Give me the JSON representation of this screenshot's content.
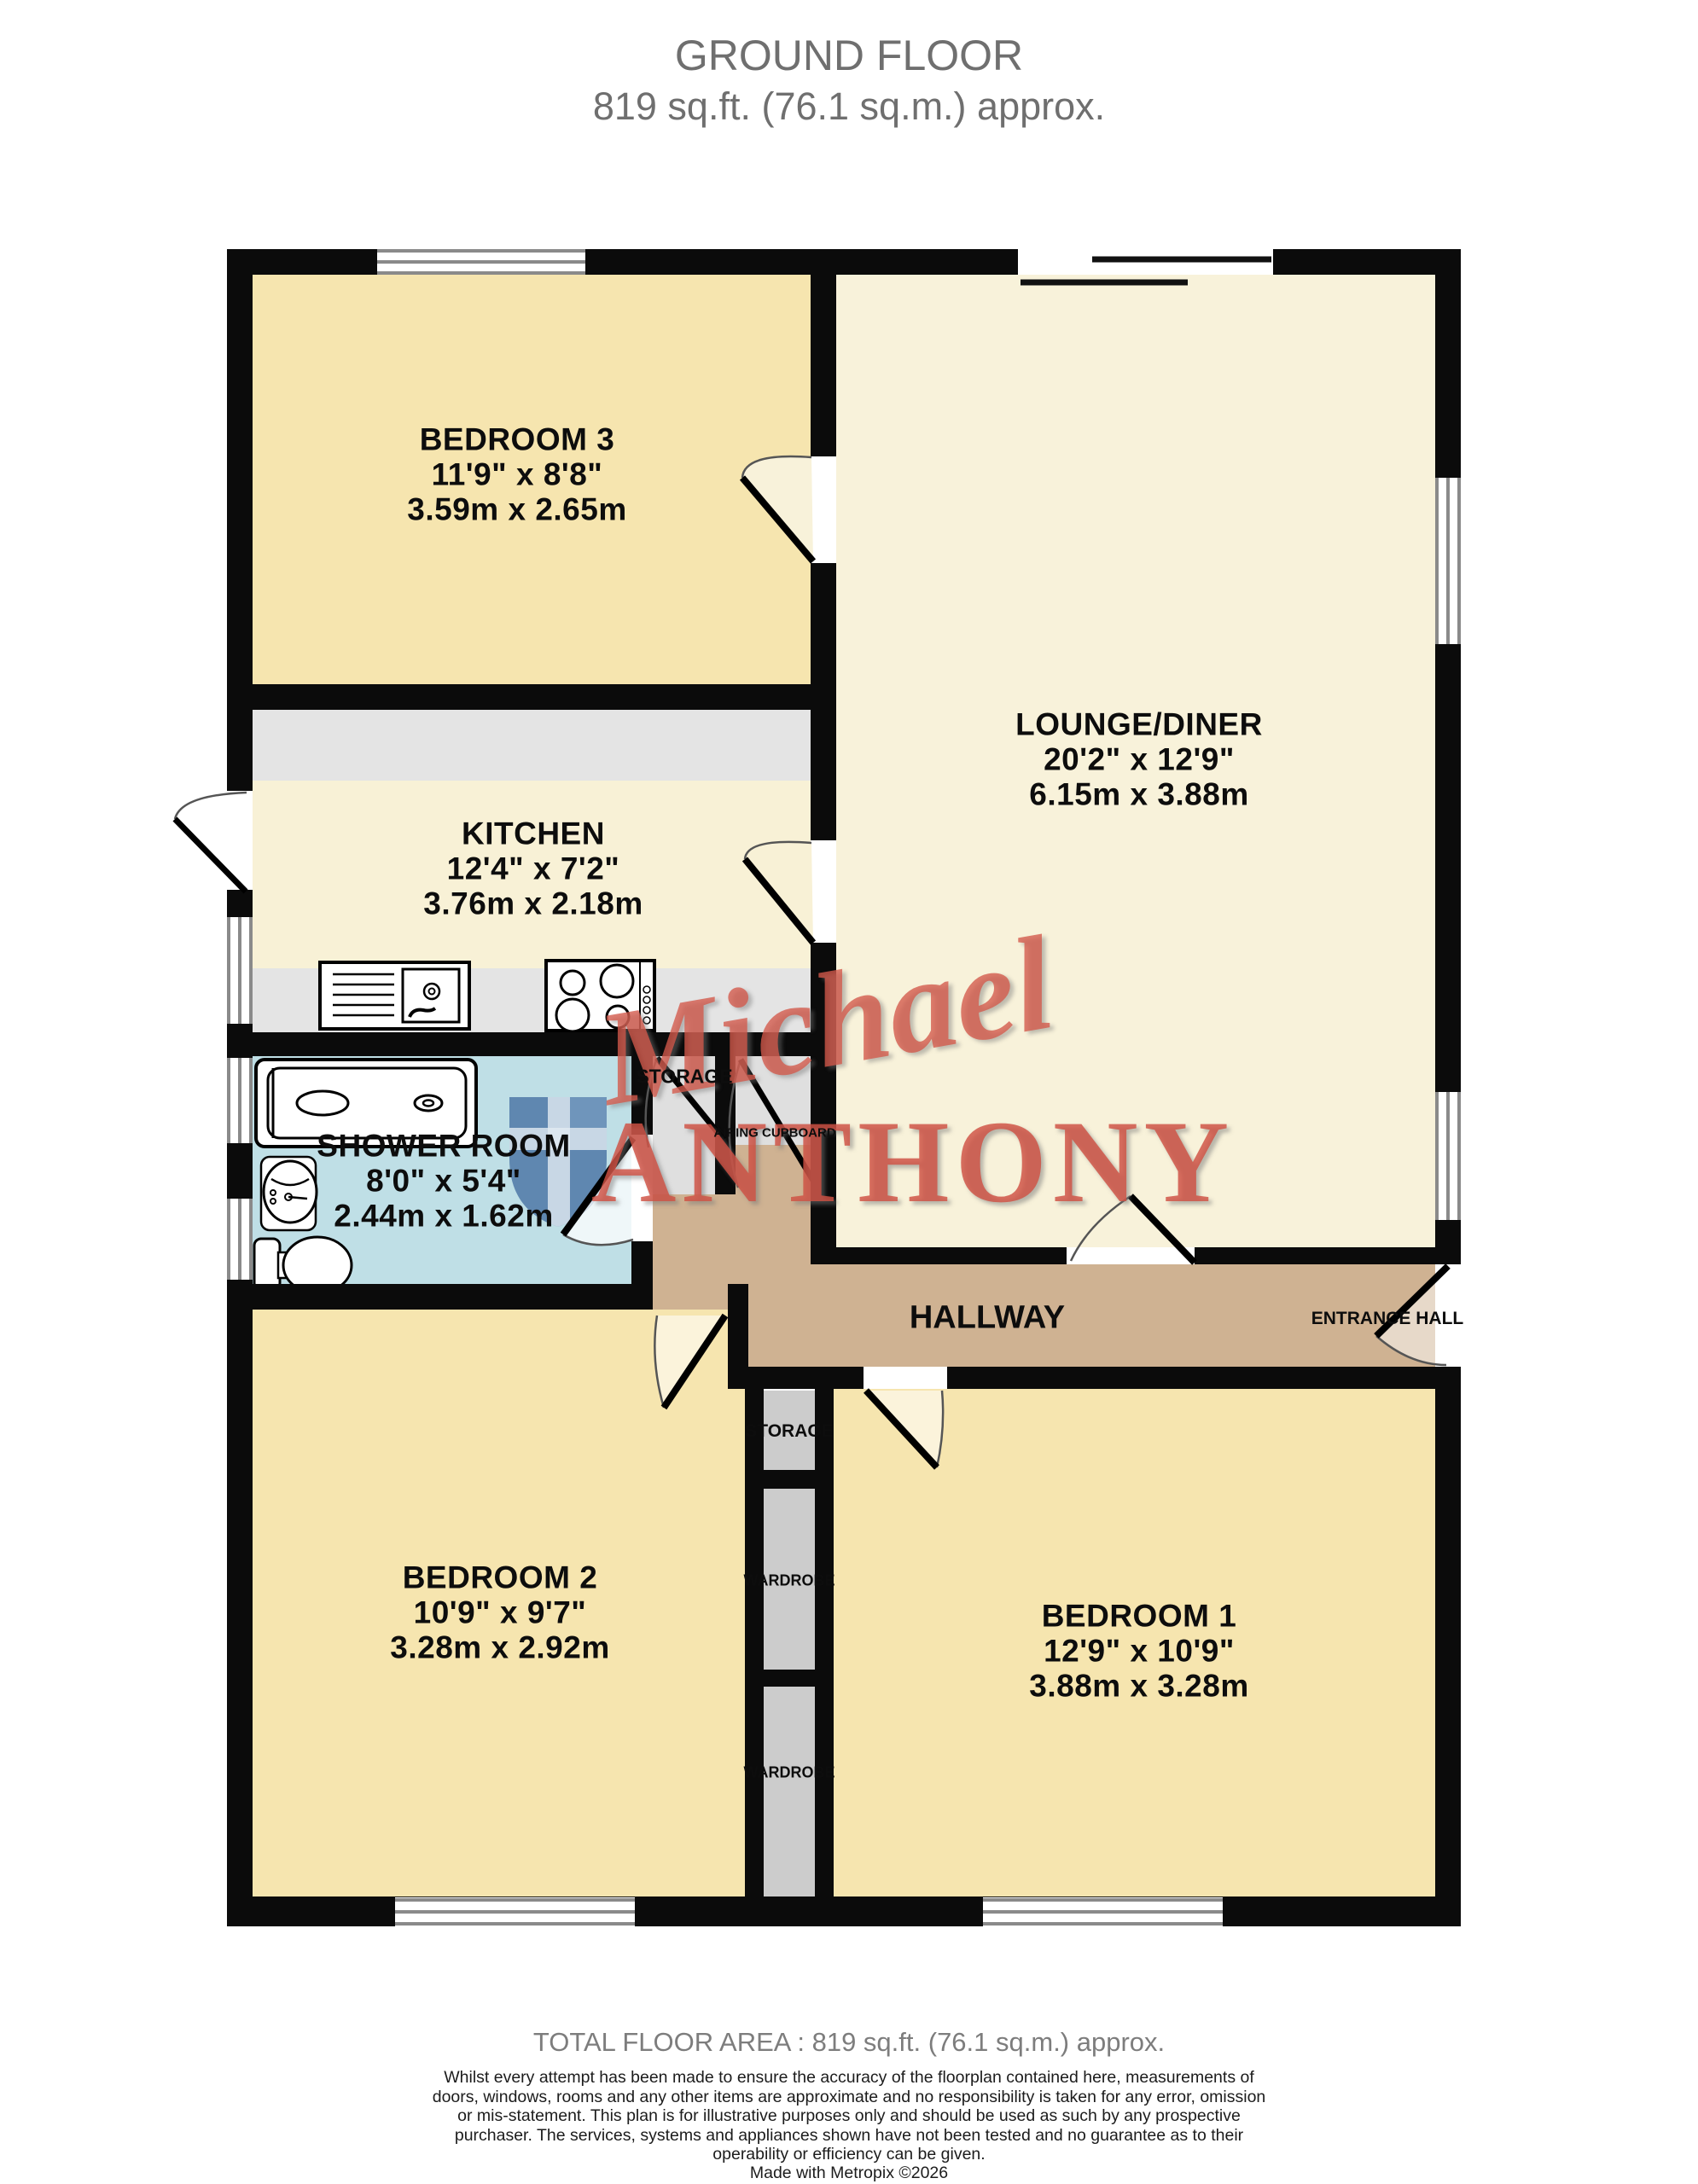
{
  "header": {
    "title": "GROUND FLOOR",
    "subtitle": "819 sq.ft. (76.1 sq.m.) approx."
  },
  "rooms": {
    "bedroom3": {
      "name": "BEDROOM 3",
      "imperial": "11'9\" x 8'8\"",
      "metric": "3.59m x 2.65m"
    },
    "lounge": {
      "name": "LOUNGE/DINER",
      "imperial": "20'2\" x 12'9\"",
      "metric": "6.15m x 3.88m"
    },
    "kitchen": {
      "name": "KITCHEN",
      "imperial": "12'4\" x 7'2\"",
      "metric": "3.76m x 2.18m"
    },
    "shower": {
      "name": "SHOWER ROOM",
      "imperial": "8'0\" x 5'4\"",
      "metric": "2.44m x 1.62m"
    },
    "hallway": {
      "name": "HALLWAY"
    },
    "entrance": {
      "name": "ENTRANCE HALL"
    },
    "bedroom2": {
      "name": "BEDROOM 2",
      "imperial": "10'9\" x 9'7\"",
      "metric": "3.28m x 2.92m"
    },
    "bedroom1": {
      "name": "BEDROOM 1",
      "imperial": "12'9\" x 10'9\"",
      "metric": "3.88m x 3.28m"
    },
    "storage_upper": {
      "name": "STORAGE"
    },
    "airing": {
      "name": "AIRING CUPBOARD"
    },
    "storage_lower": {
      "name": "STORAGE"
    },
    "wardrobe_1": {
      "name": "WARDROBE"
    },
    "wardrobe_2": {
      "name": "WARDROBE"
    }
  },
  "watermark": {
    "line1": "Michael",
    "line2": "ANTHONY"
  },
  "footer": {
    "total": "TOTAL FLOOR AREA : 819 sq.ft. (76.1 sq.m.) approx.",
    "disclaimer": "Whilst every attempt has been made to ensure the accuracy of the floorplan contained here, measurements of doors, windows, rooms and any other items are approximate and no responsibility is taken for any error, omission or mis-statement. This plan is for illustrative purposes only and should be used as such by any prospective purchaser. The services, systems and appliances shown have not been tested and no guarantee as to their operability or efficiency can be given.",
    "credit": "Made with Metropix ©2026"
  },
  "colors": {
    "wall": "#0b0b0b",
    "bedroom_fill": "#F6E5AF",
    "lounge_fill": "#F8F2DA",
    "kitchen_fill": "#F8F1D6",
    "shower_fill": "#BFDFE6",
    "hallway_fill": "#CFB292",
    "counter_fill": "#E4E4E4",
    "cupboard_fill": "#DFDFDF",
    "wardrobe_fill": "#CCCCCC",
    "watermark_red": "#D0503F",
    "shield_blue": "#4D78A6"
  }
}
